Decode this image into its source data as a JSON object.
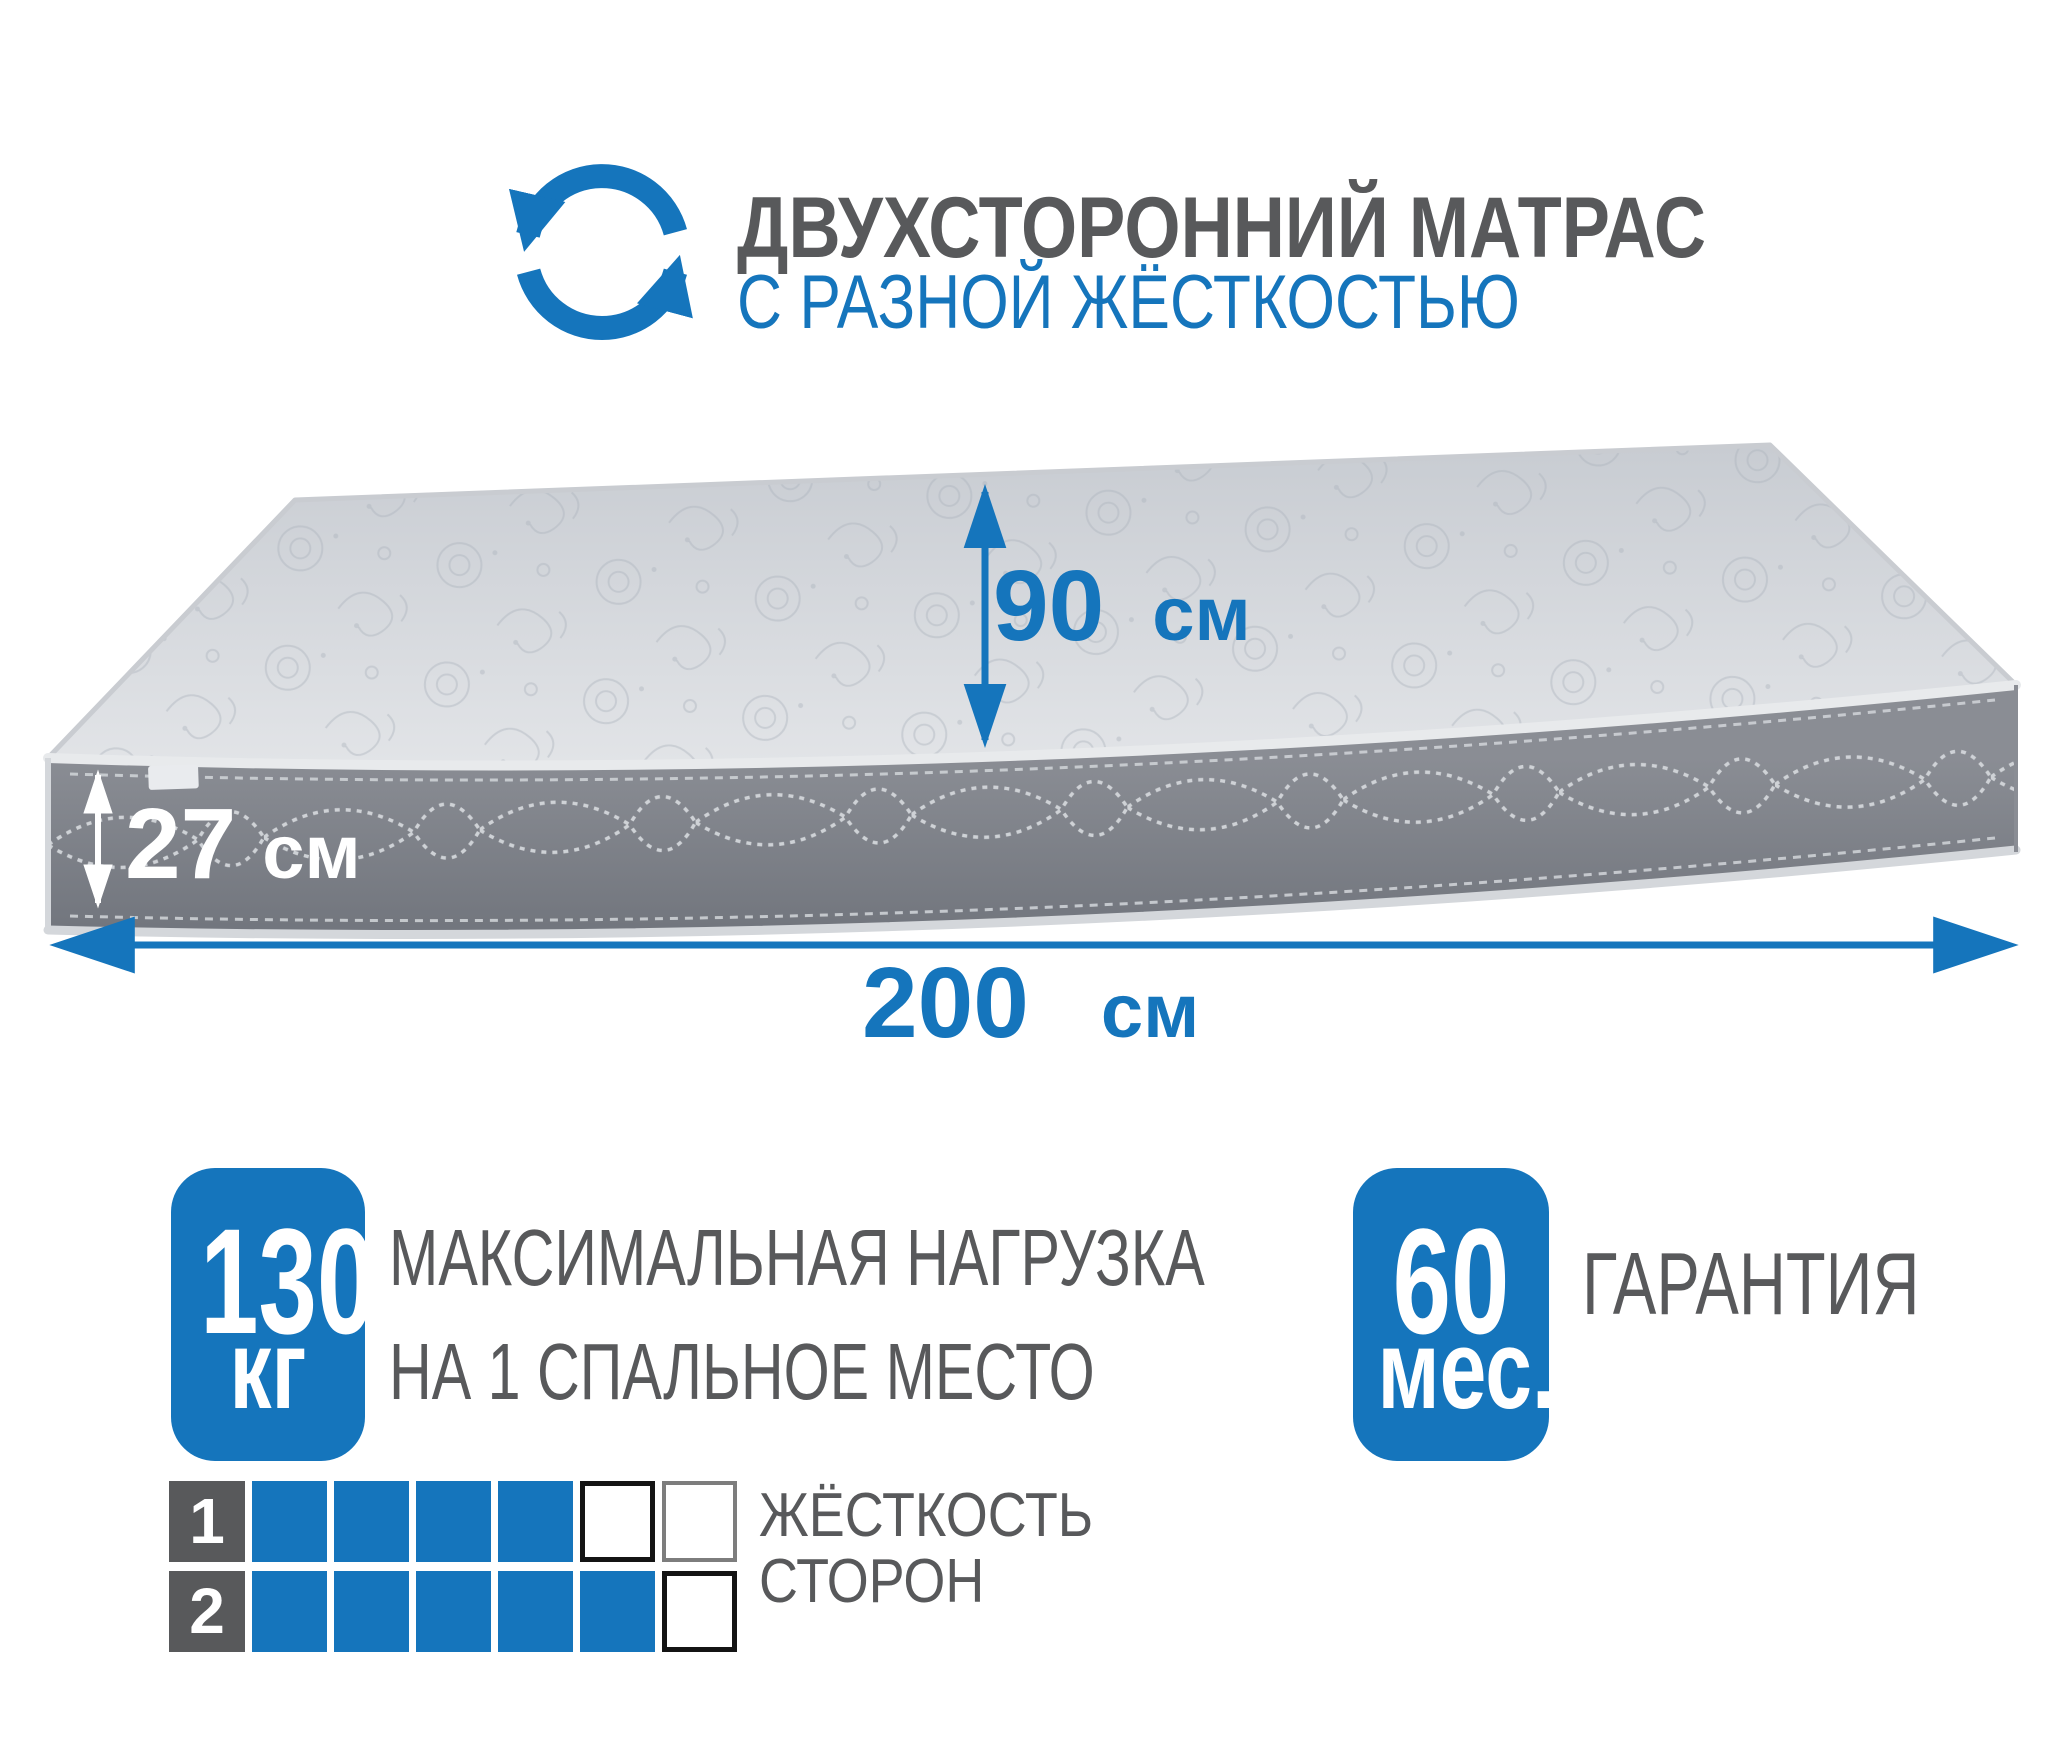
{
  "header": {
    "icon": "rotate-arrows-icon",
    "title": "ДВУХСТОРОННИЙ МАТРАС",
    "subtitle": "С РАЗНОЙ ЖЁСТКОСТЬЮ"
  },
  "mattress": {
    "height": {
      "value": "90",
      "unit": "см"
    },
    "thickness": {
      "value": "27",
      "unit": "см"
    },
    "length": {
      "value": "200",
      "unit": "см"
    }
  },
  "features": {
    "max_load": {
      "value": "130",
      "unit": "кг",
      "label": [
        "МАКСИМАЛЬНАЯ НАГРУЗКА",
        "НА 1 СПАЛЬНОЕ МЕСТО"
      ]
    },
    "warranty": {
      "value": "60",
      "unit": "мес.",
      "label": "ГАРАНТИЯ"
    }
  },
  "firmness": {
    "label": [
      "ЖЁСТКОСТЬ",
      "СТОРОН"
    ],
    "scale_max": 6,
    "sides": [
      {
        "number": "1",
        "level": 4
      },
      {
        "number": "2",
        "level": 5
      }
    ]
  },
  "colors": {
    "accent": "#1575BC",
    "text_gray": "#58595B"
  }
}
